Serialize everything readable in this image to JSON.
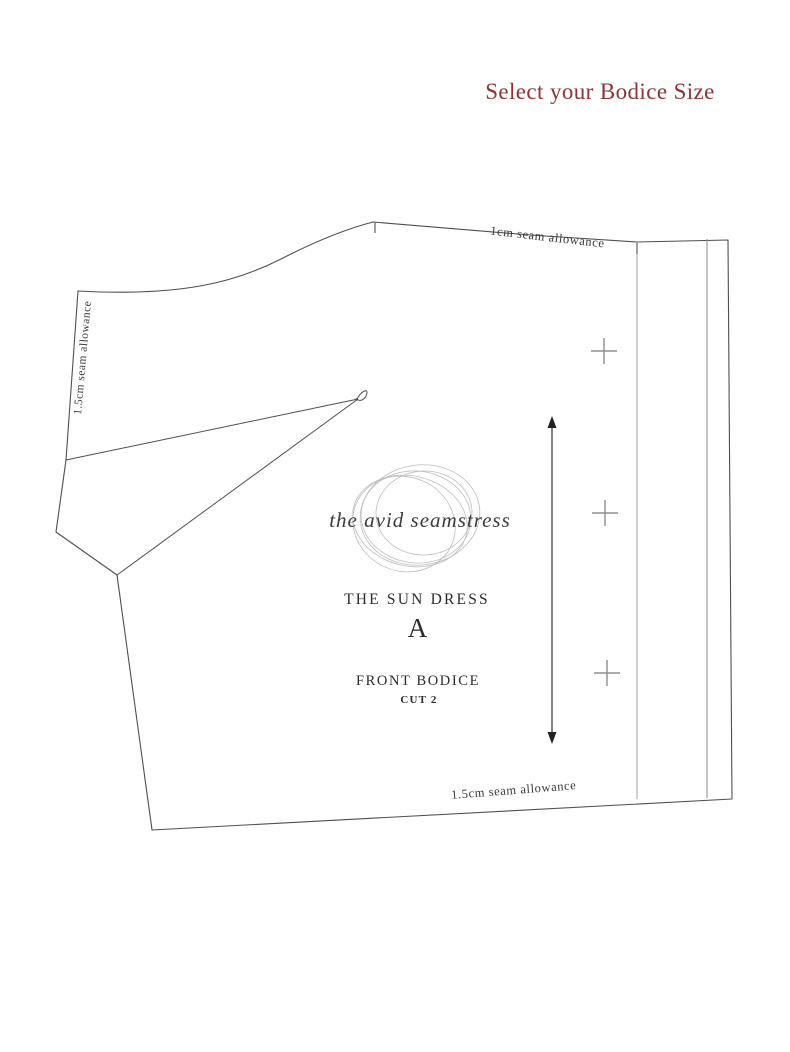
{
  "page": {
    "title": "Select your Bodice Size",
    "title_color": "#8e3434",
    "background": "#ffffff"
  },
  "pattern": {
    "brand": "the avid seamstress",
    "name": "THE SUN DRESS",
    "size": "A",
    "piece": "FRONT BODICE",
    "cut": "CUT 2",
    "labels": {
      "seam_top": "1cm seam allowance",
      "seam_left": "1.5cm seam allowance",
      "seam_bottom": "1.5cm seam allowance"
    },
    "colors": {
      "outline": "#4f4f4f",
      "guide_line": "#9c9c9c",
      "cross_mark": "#8f8f8f",
      "logo_scribble": "#bdbdbd"
    },
    "icons": {
      "grainline": "grainline-double-arrow-icon",
      "cross_marks_count": 3,
      "dart": "bust-dart"
    }
  }
}
